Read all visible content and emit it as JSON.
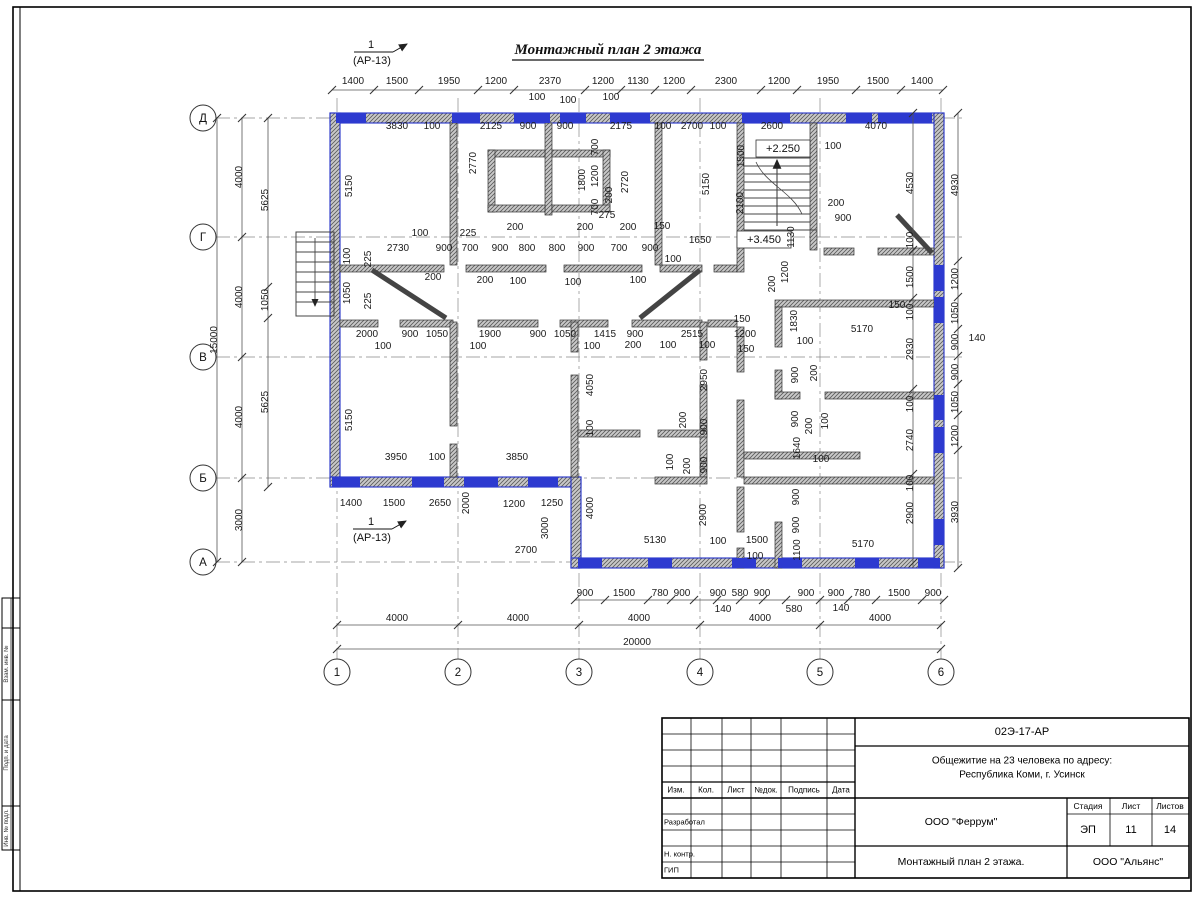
{
  "plan": {
    "title": "Монтажный план 2 этажа",
    "marker_top": {
      "num": "1",
      "ref": "(АР-13)"
    },
    "marker_bottom": {
      "num": "1",
      "ref": "(АР-13)"
    },
    "levels": {
      "stair": "+2.250",
      "mid": "+3.450"
    },
    "col_axes": [
      [
        "1",
        337
      ],
      [
        "2",
        458
      ],
      [
        "3",
        579
      ],
      [
        "4",
        700
      ],
      [
        "5",
        820
      ],
      [
        "6",
        941
      ]
    ],
    "row_axes": [
      [
        "Д",
        118
      ],
      [
        "Г",
        237
      ],
      [
        "В",
        357
      ],
      [
        "Б",
        478
      ],
      [
        "А",
        562
      ]
    ],
    "chains": [
      {
        "o": "h",
        "p": 90,
        "a": 332,
        "b": 943,
        "t": [
          332,
          374,
          419,
          478,
          514,
          585,
          621,
          655,
          691,
          761,
          797,
          856,
          901,
          943
        ]
      },
      {
        "o": "h",
        "p": 600,
        "a": 575,
        "b": 944,
        "t": [
          575,
          605,
          648,
          671,
          694,
          717,
          740,
          763,
          786,
          820,
          848,
          876,
          922,
          944
        ]
      },
      {
        "o": "h",
        "p": 625,
        "a": 337,
        "b": 941,
        "t": [
          337,
          458,
          579,
          700,
          820,
          941
        ]
      },
      {
        "o": "h",
        "p": 649,
        "a": 337,
        "b": 941,
        "t": [
          337,
          941
        ]
      },
      {
        "o": "v",
        "p": 242,
        "a": 118,
        "b": 562,
        "t": [
          118,
          237,
          357,
          478,
          562
        ]
      },
      {
        "o": "v",
        "p": 217,
        "a": 118,
        "b": 562,
        "t": [
          118,
          562
        ]
      },
      {
        "o": "v",
        "p": 268,
        "a": 118,
        "b": 487,
        "t": [
          118,
          287,
          318,
          487
        ]
      },
      {
        "o": "v",
        "p": 958,
        "a": 113,
        "b": 568,
        "t": [
          113,
          261,
          297,
          329,
          356,
          384,
          415,
          450,
          568
        ]
      },
      {
        "o": "v",
        "p": 913,
        "a": 113,
        "b": 568,
        "t": [
          113,
          250,
          298,
          389,
          474,
          563
        ]
      }
    ],
    "dims": [
      [
        "1400",
        353,
        84,
        0
      ],
      [
        "1500",
        397,
        84,
        0
      ],
      [
        "1950",
        449,
        84,
        0
      ],
      [
        "1200",
        496,
        84,
        0
      ],
      [
        "2370",
        550,
        84,
        0
      ],
      [
        "1200",
        603,
        84,
        0
      ],
      [
        "1130",
        638,
        84,
        0
      ],
      [
        "1200",
        674,
        84,
        0
      ],
      [
        "2300",
        726,
        84,
        0
      ],
      [
        "1200",
        779,
        84,
        0
      ],
      [
        "1950",
        828,
        84,
        0
      ],
      [
        "1500",
        878,
        84,
        0
      ],
      [
        "1400",
        922,
        84,
        0
      ],
      [
        "100",
        537,
        100,
        0
      ],
      [
        "100",
        568,
        103,
        0
      ],
      [
        "100",
        611,
        100,
        0
      ],
      [
        "3830",
        397,
        129,
        0
      ],
      [
        "100",
        432,
        129,
        0
      ],
      [
        "2125",
        491,
        129,
        0
      ],
      [
        "900",
        528,
        129,
        0
      ],
      [
        "900",
        565,
        129,
        0
      ],
      [
        "2175",
        621,
        129,
        0
      ],
      [
        "100",
        663,
        129,
        0
      ],
      [
        "2700",
        692,
        129,
        0
      ],
      [
        "100",
        718,
        129,
        0
      ],
      [
        "2600",
        772,
        129,
        0
      ],
      [
        "4070",
        876,
        129,
        0
      ],
      [
        "5150",
        352,
        186,
        1
      ],
      [
        "2770",
        476,
        163,
        1
      ],
      [
        "1800",
        585,
        180,
        1
      ],
      [
        "700",
        598,
        147,
        1
      ],
      [
        "1200",
        598,
        176,
        1
      ],
      [
        "700",
        598,
        207,
        1
      ],
      [
        "200",
        612,
        195,
        1
      ],
      [
        "2720",
        628,
        182,
        1
      ],
      [
        "275",
        607,
        218,
        0
      ],
      [
        "5150",
        709,
        184,
        1
      ],
      [
        "1500",
        744,
        156,
        1
      ],
      [
        "2100",
        743,
        203,
        1
      ],
      [
        "1130",
        794,
        237,
        1
      ],
      [
        "1200",
        788,
        272,
        1
      ],
      [
        "200",
        775,
        284,
        1
      ],
      [
        "100",
        833,
        149,
        0
      ],
      [
        "200",
        836,
        206,
        0
      ],
      [
        "900",
        843,
        221,
        0
      ],
      [
        "1650",
        700,
        243,
        0
      ],
      [
        "150",
        662,
        229,
        0
      ],
      [
        "200",
        515,
        230,
        0
      ],
      [
        "200",
        585,
        230,
        0
      ],
      [
        "200",
        628,
        230,
        0
      ],
      [
        "2730",
        398,
        251,
        0
      ],
      [
        "900",
        444,
        251,
        0
      ],
      [
        "700",
        470,
        251,
        0
      ],
      [
        "900",
        500,
        251,
        0
      ],
      [
        "800",
        527,
        251,
        0
      ],
      [
        "800",
        557,
        251,
        0
      ],
      [
        "900",
        586,
        251,
        0
      ],
      [
        "700",
        619,
        251,
        0
      ],
      [
        "900",
        650,
        251,
        0
      ],
      [
        "100",
        350,
        256,
        1
      ],
      [
        "1050",
        350,
        293,
        1
      ],
      [
        "225",
        371,
        259,
        1
      ],
      [
        "225",
        371,
        301,
        1
      ],
      [
        "100",
        420,
        236,
        0
      ],
      [
        "225",
        468,
        236,
        0
      ],
      [
        "200",
        433,
        280,
        0
      ],
      [
        "200",
        485,
        283,
        0
      ],
      [
        "100",
        518,
        284,
        0
      ],
      [
        "100",
        573,
        285,
        0
      ],
      [
        "100",
        638,
        283,
        0
      ],
      [
        "100",
        673,
        262,
        0
      ],
      [
        "2000",
        367,
        337,
        0
      ],
      [
        "900",
        410,
        337,
        0
      ],
      [
        "1050",
        437,
        337,
        0
      ],
      [
        "1900",
        490,
        337,
        0
      ],
      [
        "900",
        538,
        337,
        0
      ],
      [
        "1050",
        565,
        337,
        0
      ],
      [
        "1415",
        605,
        337,
        0
      ],
      [
        "900",
        635,
        337,
        0
      ],
      [
        "2515",
        692,
        337,
        0
      ],
      [
        "1200",
        745,
        337,
        0
      ],
      [
        "150",
        742,
        322,
        0
      ],
      [
        "150",
        746,
        352,
        0
      ],
      [
        "100",
        805,
        344,
        0
      ],
      [
        "1830",
        797,
        321,
        1
      ],
      [
        "5170",
        862,
        332,
        0
      ],
      [
        "150",
        897,
        308,
        0
      ],
      [
        "100",
        383,
        349,
        0
      ],
      [
        "100",
        478,
        349,
        0
      ],
      [
        "100",
        592,
        349,
        0
      ],
      [
        "200",
        633,
        348,
        0
      ],
      [
        "100",
        668,
        348,
        0
      ],
      [
        "100",
        707,
        348,
        0
      ],
      [
        "4050",
        593,
        385,
        1
      ],
      [
        "100",
        593,
        428,
        1
      ],
      [
        "2950",
        707,
        380,
        1
      ],
      [
        "900",
        707,
        427,
        1
      ],
      [
        "200",
        686,
        420,
        1
      ],
      [
        "100",
        673,
        462,
        1
      ],
      [
        "200",
        690,
        466,
        1
      ],
      [
        "900",
        707,
        465,
        1
      ],
      [
        "900",
        798,
        375,
        1
      ],
      [
        "200",
        817,
        373,
        1
      ],
      [
        "900",
        798,
        419,
        1
      ],
      [
        "200",
        812,
        426,
        1
      ],
      [
        "100",
        828,
        421,
        1
      ],
      [
        "2900",
        706,
        515,
        1
      ],
      [
        "4000",
        593,
        508,
        1
      ],
      [
        "1640",
        800,
        448,
        1
      ],
      [
        "100",
        821,
        462,
        0
      ],
      [
        "900",
        799,
        497,
        1
      ],
      [
        "900",
        799,
        525,
        1
      ],
      [
        "1100",
        800,
        550,
        1
      ],
      [
        "5170",
        863,
        547,
        0
      ],
      [
        "100",
        718,
        544,
        0
      ],
      [
        "1500",
        757,
        543,
        0
      ],
      [
        "100",
        755,
        559,
        0
      ],
      [
        "5130",
        655,
        543,
        0
      ],
      [
        "3950",
        396,
        460,
        0
      ],
      [
        "100",
        437,
        460,
        0
      ],
      [
        "3850",
        517,
        460,
        0
      ],
      [
        "1400",
        351,
        506,
        0
      ],
      [
        "1500",
        394,
        506,
        0
      ],
      [
        "2650",
        440,
        506,
        0
      ],
      [
        "2000",
        469,
        503,
        1
      ],
      [
        "1200",
        514,
        507,
        0
      ],
      [
        "1250",
        552,
        506,
        0
      ],
      [
        "3000",
        548,
        528,
        1
      ],
      [
        "2700",
        526,
        553,
        0
      ],
      [
        "5150",
        352,
        420,
        1
      ],
      [
        "900",
        585,
        596,
        0
      ],
      [
        "1500",
        624,
        596,
        0
      ],
      [
        "780",
        660,
        596,
        0
      ],
      [
        "900",
        682,
        596,
        0
      ],
      [
        "900",
        718,
        596,
        0
      ],
      [
        "580",
        740,
        596,
        0
      ],
      [
        "900",
        762,
        596,
        0
      ],
      [
        "900",
        806,
        596,
        0
      ],
      [
        "900",
        836,
        596,
        0
      ],
      [
        "780",
        862,
        596,
        0
      ],
      [
        "1500",
        899,
        596,
        0
      ],
      [
        "900",
        933,
        596,
        0
      ],
      [
        "140",
        723,
        612,
        0
      ],
      [
        "580",
        794,
        612,
        0
      ],
      [
        "140",
        841,
        611,
        0
      ],
      [
        "4000",
        397,
        621,
        0
      ],
      [
        "4000",
        518,
        621,
        0
      ],
      [
        "4000",
        639,
        621,
        0
      ],
      [
        "4000",
        760,
        621,
        0
      ],
      [
        "4000",
        880,
        621,
        0
      ],
      [
        "20000",
        637,
        645,
        0
      ],
      [
        "4000",
        242,
        177,
        1
      ],
      [
        "4000",
        242,
        297,
        1
      ],
      [
        "4000",
        242,
        417,
        1
      ],
      [
        "3000",
        242,
        520,
        1
      ],
      [
        "15000",
        217,
        340,
        1
      ],
      [
        "5625",
        268,
        200,
        1
      ],
      [
        "1050",
        268,
        300,
        1
      ],
      [
        "5625",
        268,
        402,
        1
      ],
      [
        "4930",
        958,
        185,
        1
      ],
      [
        "1200",
        958,
        279,
        1
      ],
      [
        "1050",
        958,
        313,
        1
      ],
      [
        "900",
        958,
        342,
        1
      ],
      [
        "140",
        977,
        341,
        0
      ],
      [
        "900",
        958,
        372,
        1
      ],
      [
        "1050",
        958,
        402,
        1
      ],
      [
        "1200",
        958,
        436,
        1
      ],
      [
        "3930",
        958,
        512,
        1
      ],
      [
        "4530",
        913,
        183,
        1
      ],
      [
        "100",
        913,
        240,
        1
      ],
      [
        "1500",
        913,
        277,
        1
      ],
      [
        "100",
        913,
        312,
        1
      ],
      [
        "2930",
        913,
        349,
        1
      ],
      [
        "100",
        913,
        404,
        1
      ],
      [
        "2740",
        913,
        440,
        1
      ],
      [
        "100",
        913,
        483,
        1
      ],
      [
        "2900",
        913,
        513,
        1
      ]
    ]
  },
  "margin_stamps": [
    "Взам. инв. №",
    "Подп. и дата",
    "Инв. № подл."
  ],
  "titleblock": {
    "doc_code": "02Э-17-АР",
    "project_line1": "Общежитие на 23 человека по адресу:",
    "project_line2": "Республика Коми, г. Усинск",
    "contractor": "ООО \"Феррум\"",
    "sheet_title": "Монтажный план 2 этажа.",
    "company": "ООО \"Альянс\"",
    "stage_label": "Стадия",
    "sheet_label": "Лист",
    "sheets_label": "Листов",
    "stage": "ЭП",
    "sheet_no": "11",
    "sheets_total": "14",
    "header_cols": [
      "Изм.",
      "Кол.",
      "Лист",
      "№док.",
      "Подпись",
      "Дата"
    ],
    "roles": [
      "Разработал",
      "Н. контр.",
      "ГИП"
    ]
  }
}
